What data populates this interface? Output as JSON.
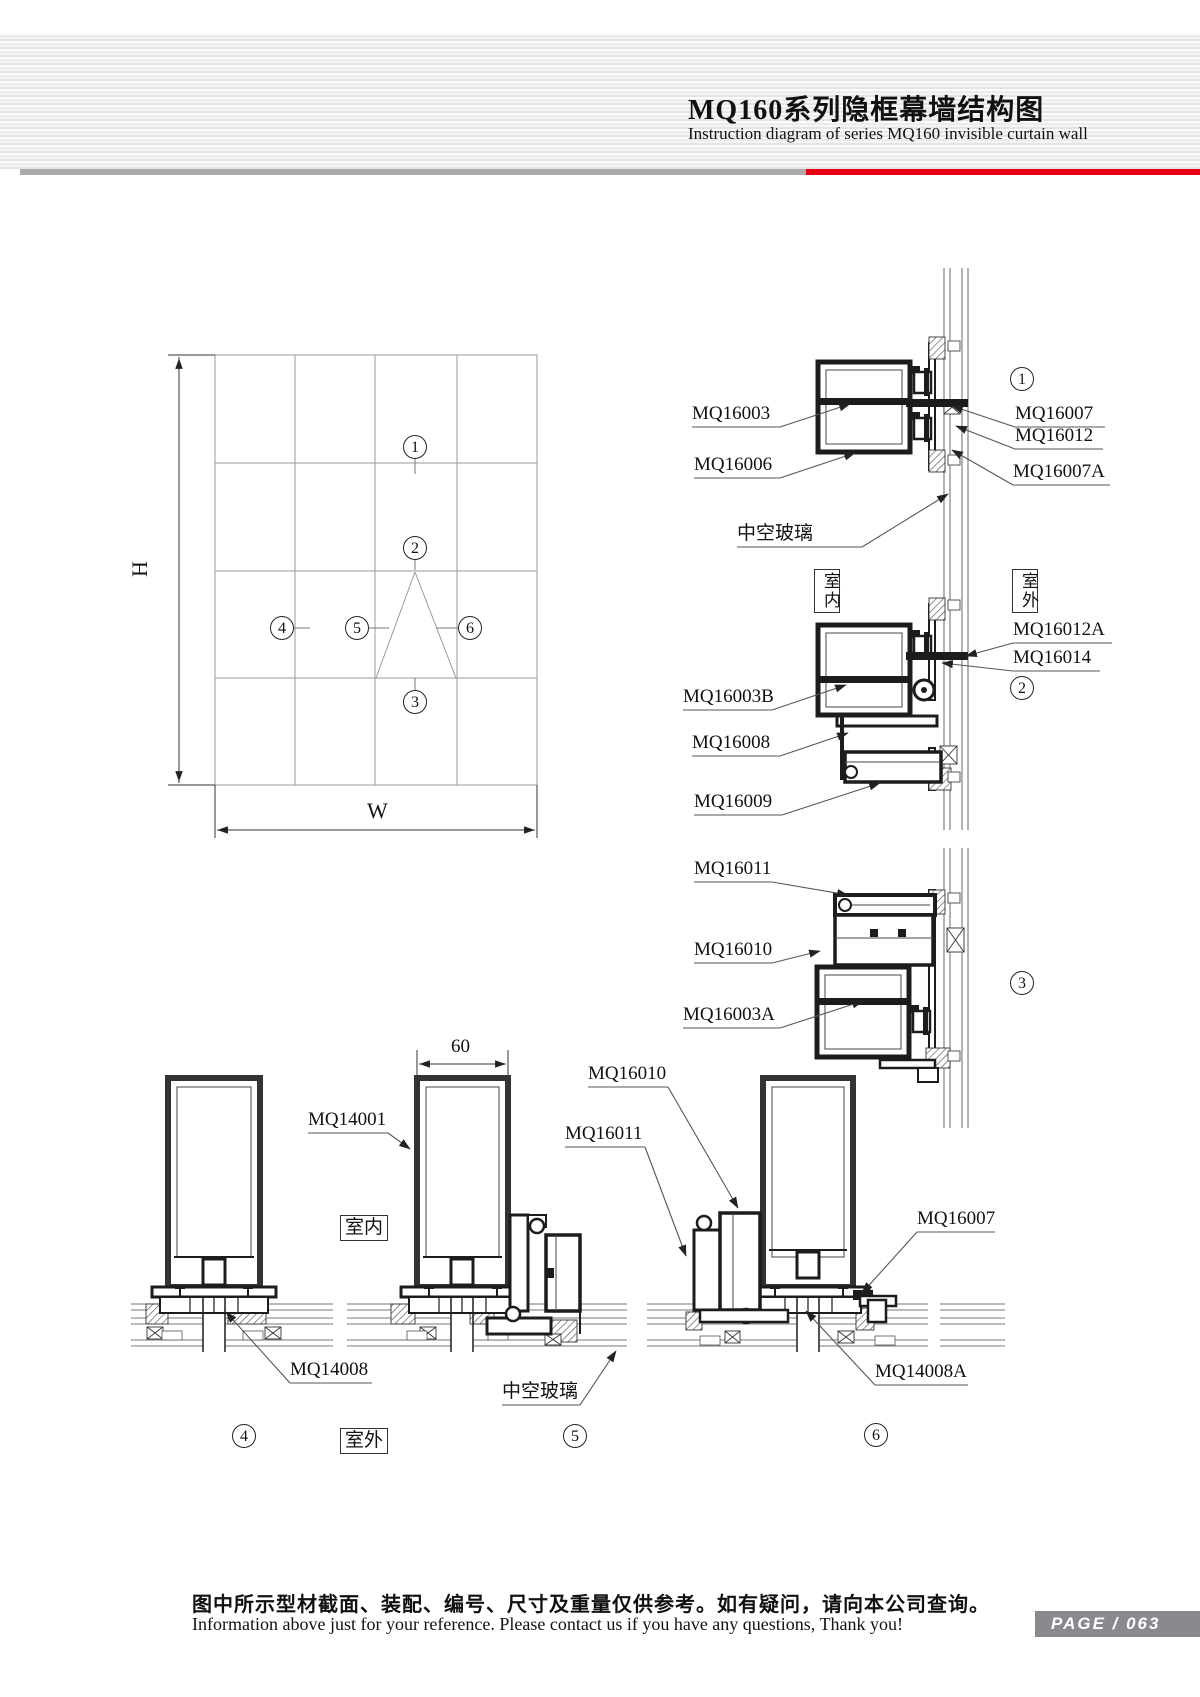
{
  "header": {
    "title_cn": "MQ160系列隐框幕墙结构图",
    "title_en": "Instruction diagram of series MQ160 invisible curtain wall",
    "accent_color": "#e60012",
    "divider_gray": "#ababab"
  },
  "elevation": {
    "dim_height": "H",
    "dim_width": "W",
    "markers": [
      "1",
      "2",
      "3",
      "4",
      "5",
      "6"
    ]
  },
  "dims": {
    "mullion_width": "60"
  },
  "zone_labels": {
    "indoor": "室内",
    "outdoor": "室外"
  },
  "part_labels": [
    {
      "id": "mq16003",
      "text": "MQ16003"
    },
    {
      "id": "mq16006",
      "text": "MQ16006"
    },
    {
      "id": "glass-top",
      "text": "中空玻璃"
    },
    {
      "id": "mq16007",
      "text": "MQ16007"
    },
    {
      "id": "mq16012",
      "text": "MQ16012"
    },
    {
      "id": "mq16007a",
      "text": "MQ16007A"
    },
    {
      "id": "mq16003b",
      "text": "MQ16003B"
    },
    {
      "id": "mq16008",
      "text": "MQ16008"
    },
    {
      "id": "mq16009",
      "text": "MQ16009"
    },
    {
      "id": "mq16012a",
      "text": "MQ16012A"
    },
    {
      "id": "mq16014",
      "text": "MQ16014"
    },
    {
      "id": "mq16011-d3",
      "text": "MQ16011"
    },
    {
      "id": "mq16010-d3",
      "text": "MQ16010"
    },
    {
      "id": "mq16003a",
      "text": "MQ16003A"
    },
    {
      "id": "mq14001",
      "text": "MQ14001"
    },
    {
      "id": "mq16010-btm",
      "text": "MQ16010"
    },
    {
      "id": "mq16011-btm",
      "text": "MQ16011"
    },
    {
      "id": "mq16007-btm",
      "text": "MQ16007"
    },
    {
      "id": "mq14008",
      "text": "MQ14008"
    },
    {
      "id": "glass-btm",
      "text": "中空玻璃"
    },
    {
      "id": "mq14008a",
      "text": "MQ14008A"
    }
  ],
  "footer": {
    "note_cn": "图中所示型材截面、装配、编号、尺寸及重量仅供参考。如有疑问，请向本公司查询。",
    "note_en": "Information above just for your reference. Please contact us if you have any questions, Thank you!",
    "page_label": "PAGE / 063"
  }
}
